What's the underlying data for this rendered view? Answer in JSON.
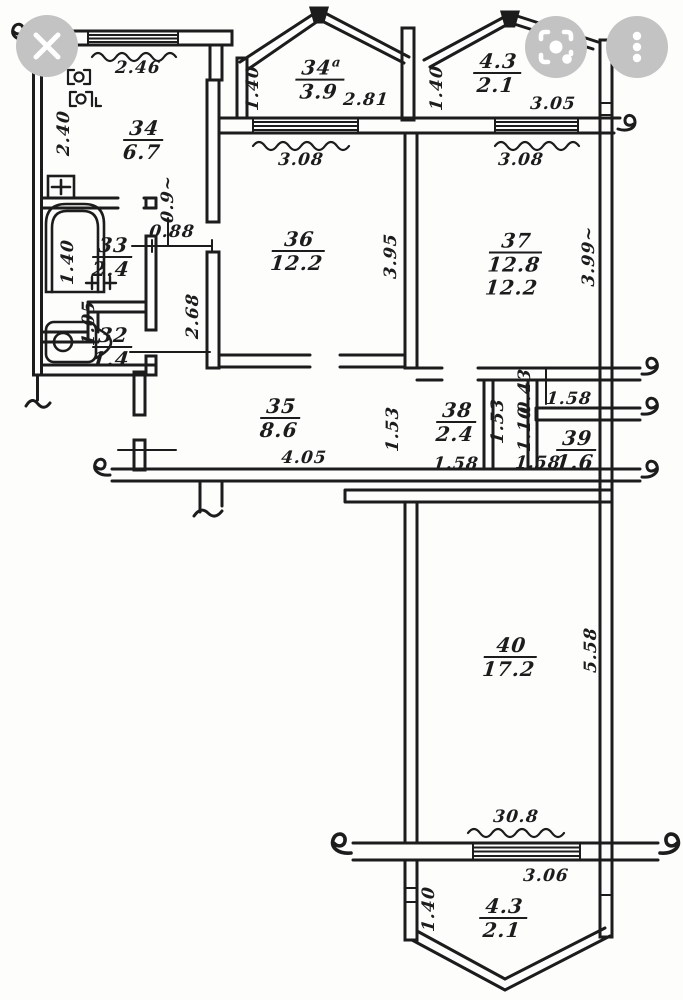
{
  "ui": {
    "button_bg": "#c3c3c3",
    "icon_color": "#ffffff",
    "buttons": [
      {
        "name": "close",
        "icon": "close-icon"
      },
      {
        "name": "camera-search",
        "icon": "camera-lens-icon"
      },
      {
        "name": "more-options",
        "icon": "three-dot-menu-icon"
      }
    ]
  },
  "drawing": {
    "title": "apartment floor plan",
    "ink_color": "#1c1c1c",
    "paper_color": "#fdfdfc",
    "labels": [
      {
        "kind": "room",
        "num": "34",
        "sup": "a",
        "area": "3.9",
        "x": 320,
        "y": 80
      },
      {
        "kind": "room",
        "num": "4.3",
        "area": "2.1",
        "x": 497,
        "y": 74
      },
      {
        "kind": "room",
        "num": "34",
        "area": "6.7",
        "x": 143,
        "y": 141
      },
      {
        "kind": "room",
        "num": "33",
        "area": "2.4",
        "x": 112,
        "y": 258
      },
      {
        "kind": "room",
        "num": "32",
        "area": "1.4",
        "x": 112,
        "y": 348
      },
      {
        "kind": "room",
        "num": "36",
        "area": "12.2",
        "x": 298,
        "y": 252
      },
      {
        "kind": "room",
        "num": "37",
        "area": "12.8",
        "extra": "12.2",
        "x": 514,
        "y": 265
      },
      {
        "kind": "room",
        "num": "35",
        "area": "8.6",
        "x": 280,
        "y": 419
      },
      {
        "kind": "room",
        "num": "38",
        "area": "2.4",
        "x": 456,
        "y": 423
      },
      {
        "kind": "room",
        "num": "39",
        "area": "1.6",
        "x": 576,
        "y": 451
      },
      {
        "kind": "room",
        "num": "40",
        "area": "17.2",
        "x": 510,
        "y": 658
      },
      {
        "kind": "room",
        "num": "4.3",
        "area": "2.1",
        "x": 503,
        "y": 919
      },
      {
        "kind": "dim",
        "text": "2.46",
        "x": 138,
        "y": 68
      },
      {
        "kind": "dim",
        "text": "1.40",
        "x": 253,
        "y": 88,
        "rot": -90
      },
      {
        "kind": "dim",
        "text": "2.81",
        "x": 366,
        "y": 100
      },
      {
        "kind": "dim",
        "text": "1.40",
        "x": 437,
        "y": 88,
        "rot": -90
      },
      {
        "kind": "dim",
        "text": "3.05",
        "x": 553,
        "y": 104
      },
      {
        "kind": "dim",
        "text": "3.08",
        "x": 301,
        "y": 160
      },
      {
        "kind": "dim",
        "text": "3.08",
        "x": 521,
        "y": 160
      },
      {
        "kind": "dim",
        "text": "2.40",
        "x": 64,
        "y": 133,
        "rot": -90
      },
      {
        "kind": "dim",
        "text": "0.9~",
        "x": 168,
        "y": 199,
        "rot": -90
      },
      {
        "kind": "dim",
        "text": "0.88",
        "x": 172,
        "y": 232
      },
      {
        "kind": "dim",
        "text": "1.40",
        "x": 68,
        "y": 262,
        "rot": -90
      },
      {
        "kind": "dim",
        "text": "2.68",
        "x": 193,
        "y": 316,
        "rot": -90
      },
      {
        "kind": "dim",
        "text": "1.05",
        "x": 89,
        "y": 323,
        "rot": -90
      },
      {
        "kind": "dim",
        "text": "3.95",
        "x": 391,
        "y": 256,
        "rot": -90
      },
      {
        "kind": "dim",
        "text": "3.99~",
        "x": 589,
        "y": 256,
        "rot": -90
      },
      {
        "kind": "dim",
        "text": "4.05",
        "x": 304,
        "y": 458
      },
      {
        "kind": "dim",
        "text": "1.53",
        "x": 393,
        "y": 429,
        "rot": -90
      },
      {
        "kind": "dim",
        "text": "1.58",
        "x": 456,
        "y": 464
      },
      {
        "kind": "dim",
        "text": "1.53",
        "x": 498,
        "y": 421,
        "rot": -90
      },
      {
        "kind": "dim",
        "text": "0.43",
        "x": 525,
        "y": 391,
        "rot": -90
      },
      {
        "kind": "dim",
        "text": "1.10",
        "x": 525,
        "y": 429,
        "rot": -90
      },
      {
        "kind": "dim",
        "text": "1.58",
        "x": 569,
        "y": 399
      },
      {
        "kind": "dim",
        "text": "1.58",
        "x": 538,
        "y": 463
      },
      {
        "kind": "dim",
        "text": "5.58",
        "x": 591,
        "y": 650,
        "rot": -90
      },
      {
        "kind": "dim",
        "text": "30.8",
        "x": 516,
        "y": 817
      },
      {
        "kind": "dim",
        "text": "3.06",
        "x": 546,
        "y": 876
      },
      {
        "kind": "dim",
        "text": "1.40",
        "x": 429,
        "y": 909,
        "rot": -90
      }
    ]
  }
}
